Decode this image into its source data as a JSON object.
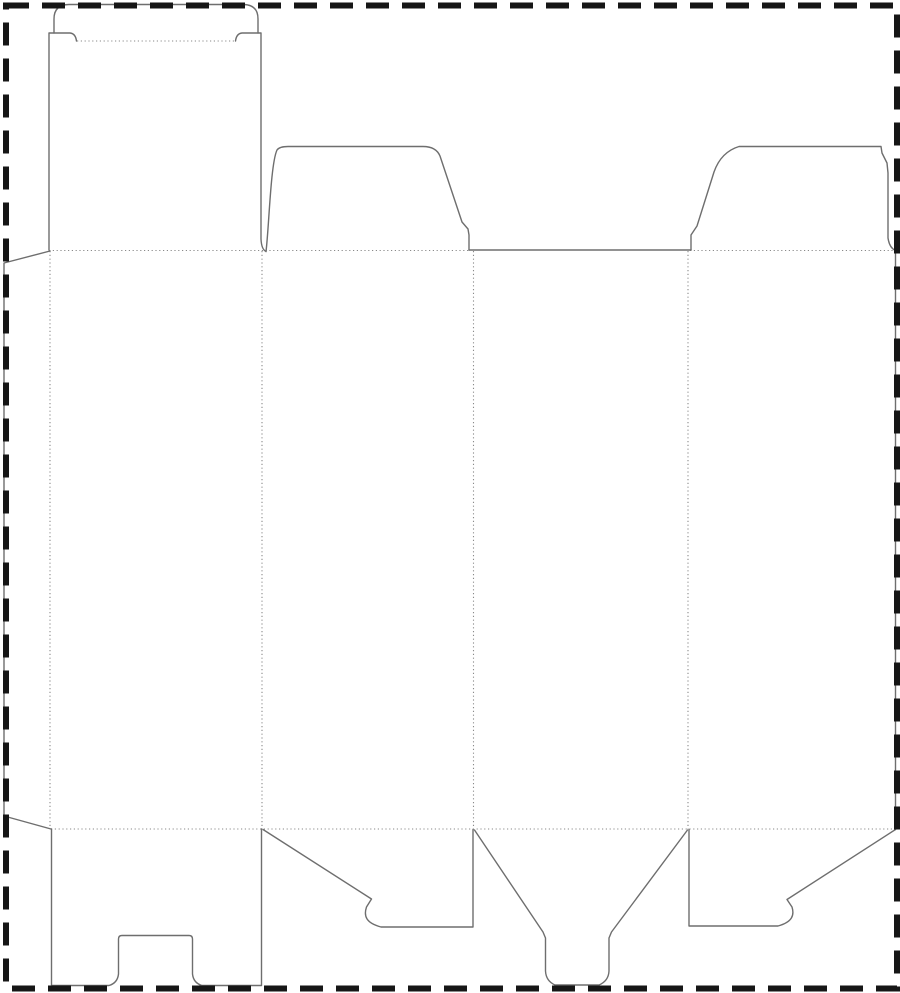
{
  "image": {
    "description": "Die-cut template (dieline) for a folding carton box: tuck-top lid with slit locks, two rounded dust flaps, tapered glue flap, four body panels and a snap-lock (1-2-3) bottom",
    "width_px": 900,
    "height_px": 993
  },
  "colors": {
    "background": "#ffffff",
    "cut_line": "#6e6e6e",
    "fold_line": "#8a8a8a",
    "border": "#161616"
  },
  "line_legend": {
    "solid_gray": "cut line",
    "dotted_gray": "fold / crease line",
    "thick_dashed_black": "sheet boundary"
  },
  "parts": {
    "glue_flap": "tapered glue flap (far left)",
    "tuck_lid": "tall tuck-top lid flap with rounded tongue and lock slits",
    "dust_flap_left": "top dust flap over panel 2",
    "dust_flap_right": "top dust flap over panel 4",
    "panel_1": "body panel 1",
    "panel_2": "body panel 2",
    "panel_3": "body panel 3",
    "panel_4": "body panel 4",
    "bottom_flap_notched": "bottom flap with center notch (panel 1)",
    "bottom_flap_hook_left": "snap-lock hook flap (panel 2)",
    "bottom_tongue": "center snap-lock tongue flap (panel 3)",
    "bottom_flap_hook_right": "snap-lock hook flap (panel 4)"
  }
}
